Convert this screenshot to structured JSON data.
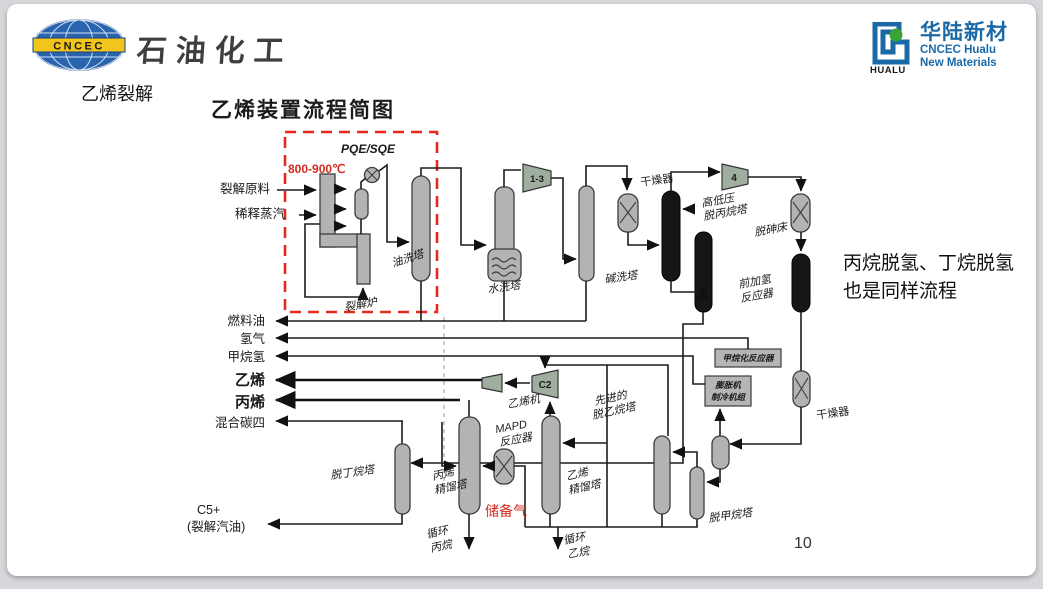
{
  "header": {
    "cncec_logo_text": "CNCEC",
    "brand_text": "石油化工",
    "hualu": {
      "logo_text": "HUALU",
      "name_cn": "华陆新材",
      "name_en1": "CNCEC Hualu",
      "name_en2": "New Materials"
    }
  },
  "slide": {
    "section_label": "乙烯裂解",
    "title": "乙烯装置流程简图",
    "note_line1": "丙烷脱氢、丁烷脱氢",
    "note_line2": "也是同样流程",
    "page_number": "10"
  },
  "diagram": {
    "temperature": "800-900℃",
    "pqe_label": "PQE/SQE",
    "furnace_label": "裂解炉",
    "feed1": "裂解原料",
    "feed2": "稀释蒸汽",
    "products": {
      "fuel_oil": "燃料油",
      "hydrogen": "氢气",
      "methane_h2": "甲烷氢",
      "ethylene": "乙烯",
      "propylene": "丙烯",
      "mixed_c4": "混合碳四",
      "c5_line1": "C5+",
      "c5_line2": "(裂解汽油)"
    },
    "equipment": {
      "oil_wash_tower": "油洗塔",
      "water_wash_tower": "水洗塔",
      "caustic_wash_tower": "碱洗塔",
      "dryer1": "干燥器",
      "depropanizer_line1": "高低压",
      "depropanizer_line2": "脱丙烷塔",
      "arsenic_bed": "脱砷床",
      "front_hydro_line1": "前加氢",
      "front_hydro_line2": "反应器",
      "methanation_reactor": "甲烷化反应器",
      "expander_line1": "膨胀机",
      "expander_line2": "制冷机组",
      "dryer2": "干燥器",
      "demethanizer": "脱甲烷塔",
      "deethanizer_line1": "先进的",
      "deethanizer_line2": "脱乙烷塔",
      "ethylene_tower_line1": "乙烯",
      "ethylene_tower_line2": "精馏塔",
      "propylene_tower_line1": "丙烯",
      "propylene_tower_line2": "精馏塔",
      "mapd_line1": "MAPD",
      "mapd_line2": "反应器",
      "debutanizer": "脱丁烷塔",
      "ethylene_compressor": "乙烯机"
    },
    "streams": {
      "storage_gas": "储备气",
      "recycle_propane_line1": "循环",
      "recycle_propane_line2": "丙烷",
      "recycle_ethane_line1": "循环",
      "recycle_ethane_line2": "乙烷"
    },
    "compressors": {
      "c13": "1-3",
      "c4": "4",
      "c2": "C2"
    },
    "colors": {
      "red_annotation": "#d42a1e",
      "hualu_blue": "#1b6aa8",
      "cncec_blue": "#2a63ae"
    }
  }
}
